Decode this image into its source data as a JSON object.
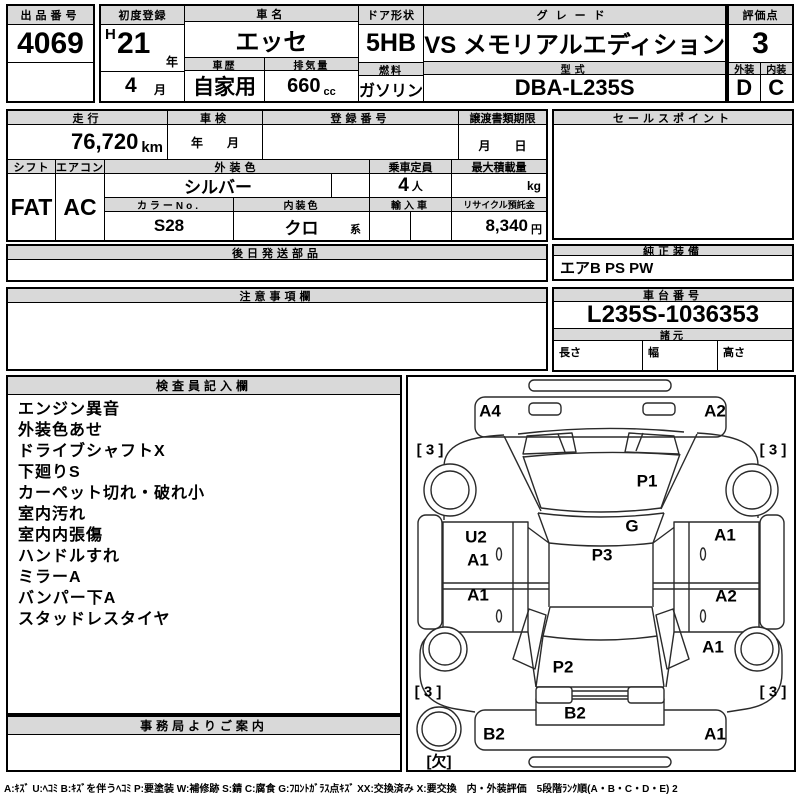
{
  "top": {
    "lot_label": "出品番号",
    "lot_number": "4069",
    "first_reg_label": "初度登録",
    "era": "H",
    "reg_year": "21",
    "year_suffix": "年",
    "reg_month": "4",
    "month_suffix": "月",
    "car_name_label": "車名",
    "car_name": "エッセ",
    "history_label": "車歴",
    "history": "自家用",
    "displacement_label": "排気量",
    "displacement": "660",
    "displacement_unit": "cc",
    "door_label": "ドア形状",
    "door": "5HB",
    "fuel_label": "燃料",
    "fuel": "ガソリン",
    "grade_label": "グレード",
    "grade": "VS メモリアルエディション",
    "model_label": "型式",
    "model": "DBA-L235S",
    "score_label": "評価点",
    "score": "3",
    "exterior_label": "外装",
    "exterior_grade": "D",
    "interior_label": "内装",
    "interior_grade": "C"
  },
  "details": {
    "mileage_label": "走行",
    "mileage": "76,720",
    "mileage_unit": "km",
    "inspection_label": "車検",
    "inspection_value": "年　　月",
    "reg_number_label": "登録番号",
    "reg_number": "",
    "transfer_label": "譲渡書類期限",
    "transfer_value": "月　　日",
    "sales_point_label": "セールスポイント",
    "sales_point": "",
    "shift_label": "シフト",
    "shift": "FAT",
    "aircon_label": "エアコン",
    "aircon": "AC",
    "ext_color_label": "外装色",
    "ext_color": "シルバー",
    "capacity_label": "乗車定員",
    "capacity": "4",
    "capacity_unit": "人",
    "max_load_label": "最大積載量",
    "max_load": "",
    "max_load_unit": "kg",
    "color_no_label": "カラーNo.",
    "color_no": "S28",
    "int_color_label": "内装色",
    "int_color": "クロ",
    "int_color_suffix": "系",
    "import_label": "輸入車",
    "recycle_label": "リサイクル預託金",
    "recycle": "8,340",
    "recycle_unit": "円",
    "later_parts_label": "後日発送部品",
    "later_parts": "",
    "notes_label": "注意事項欄",
    "notes": "",
    "equipment_label": "純正装備",
    "equipment": "エアB PS PW",
    "chassis_label": "車台番号",
    "chassis": "L235S-1036353",
    "specs_label": "諸元",
    "length_label": "長さ",
    "width_label": "幅",
    "height_label": "高さ",
    "length": "",
    "width": "",
    "height": ""
  },
  "inspector": {
    "title": "検査員記入欄",
    "notes": [
      "エンジン異音",
      "外装色あせ",
      "ドライブシャフトX",
      "下廻りS",
      "カーペット切れ・破れ小",
      "室内汚れ",
      "室内内張傷",
      "ハンドルすれ",
      "ミラーA",
      "バンパー下A",
      "スタッドレスタイヤ"
    ]
  },
  "office": {
    "title": "事務局よりご案内",
    "content": ""
  },
  "diagram": {
    "marks": [
      {
        "code": "A4",
        "part": "front-bumper-left",
        "x": 82,
        "y": 34
      },
      {
        "code": "A2",
        "part": "front-bumper-right",
        "x": 307,
        "y": 34
      },
      {
        "code": "P1",
        "part": "hood",
        "x": 239,
        "y": 104
      },
      {
        "code": "G",
        "part": "windshield",
        "x": 224,
        "y": 149
      },
      {
        "code": "U2",
        "part": "left-front-door-upper",
        "x": 68,
        "y": 160
      },
      {
        "code": "A1",
        "part": "right-front-door",
        "x": 317,
        "y": 158
      },
      {
        "code": "A1",
        "part": "left-front-door",
        "x": 70,
        "y": 183
      },
      {
        "code": "P3",
        "part": "roof",
        "x": 194,
        "y": 178
      },
      {
        "code": "A1",
        "part": "left-rear-door",
        "x": 70,
        "y": 218
      },
      {
        "code": "A2",
        "part": "right-rear-door",
        "x": 318,
        "y": 219
      },
      {
        "code": "A1",
        "part": "right-quarter",
        "x": 305,
        "y": 270
      },
      {
        "code": "P2",
        "part": "tailgate",
        "x": 155,
        "y": 290
      },
      {
        "code": "B2",
        "part": "tailgate-lower",
        "x": 167,
        "y": 336
      },
      {
        "code": "B2",
        "part": "rear-bumper-left",
        "x": 86,
        "y": 357
      },
      {
        "code": "A1",
        "part": "rear-bumper-right",
        "x": 307,
        "y": 357
      }
    ],
    "tire_depths": [
      {
        "label": "[ 3 ]",
        "position": "front-left",
        "x": 22,
        "y": 73
      },
      {
        "label": "[ 3 ]",
        "position": "front-right",
        "x": 365,
        "y": 73
      },
      {
        "label": "[ 3 ]",
        "position": "rear-left",
        "x": 20,
        "y": 315
      },
      {
        "label": "[ 3 ]",
        "position": "rear-right",
        "x": 365,
        "y": 315
      }
    ],
    "spare": {
      "label": "[欠]",
      "position": "spare-tire",
      "x": 31,
      "y": 385
    }
  },
  "legend": "A:ｷｽﾞ U:ﾍｺﾐ B:ｷｽﾞを伴うﾍｺﾐ P:要塗装 W:補修跡 S:錆 C:腐食 G:ﾌﾛﾝﾄｶﾞﾗｽ点ｷｽﾞ XX:交換済み X:要交換　内・外装評価　5段階ﾗﾝｸ順(A・B・C・D・E) 2"
}
